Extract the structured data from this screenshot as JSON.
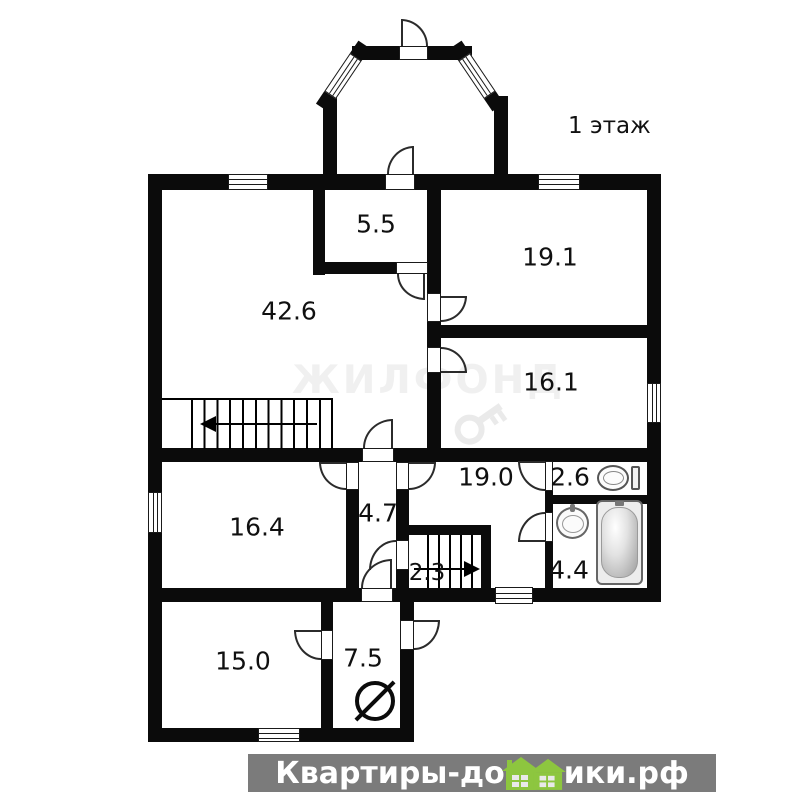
{
  "title": "1 этаж",
  "areas": {
    "closet": "5.5",
    "living": "42.6",
    "bedroom1": "19.1",
    "bedroom2": "16.1",
    "hall": "19.0",
    "wc": "2.6",
    "corridor": "4.7",
    "room_left": "16.4",
    "cellar_stairs": "2.3",
    "bathroom": "4.4",
    "room_bottom": "15.0",
    "boiler_room": "7.5"
  },
  "watermark": {
    "brand": "ЖИЛФОНД"
  },
  "footer": {
    "part1": "Квартиры-до",
    "part2": "ики.рф"
  },
  "colors": {
    "wall": "#0b0b0b",
    "banner_bg": "#7b7b7b",
    "house_green": "#8dc63f"
  }
}
